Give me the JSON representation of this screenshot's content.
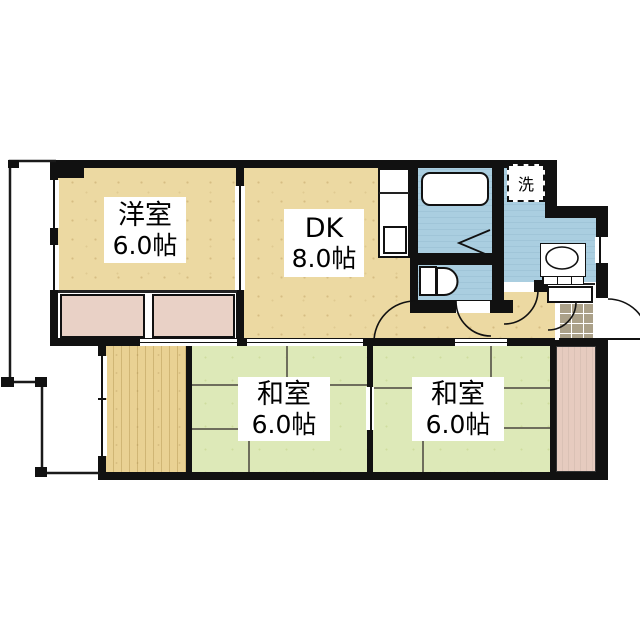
{
  "rooms": {
    "western": {
      "name": "洋室",
      "size": "6.0帖"
    },
    "dk": {
      "name": "DK",
      "size": "8.0帖"
    },
    "washitsu1": {
      "name": "和室",
      "size": "6.0帖"
    },
    "washitsu2": {
      "name": "和室",
      "size": "6.0帖"
    }
  },
  "fixtures": {
    "laundry_label": "洗"
  },
  "colors": {
    "wall": "#111111",
    "flooring": "#ecd9a2",
    "wood_flooring": "#e9d193",
    "tatami": "#dde9b8",
    "wet_area": "#aacee0",
    "closet": "#e9d1c6",
    "entrance_tile": "#aba189",
    "background": "#ffffff"
  }
}
